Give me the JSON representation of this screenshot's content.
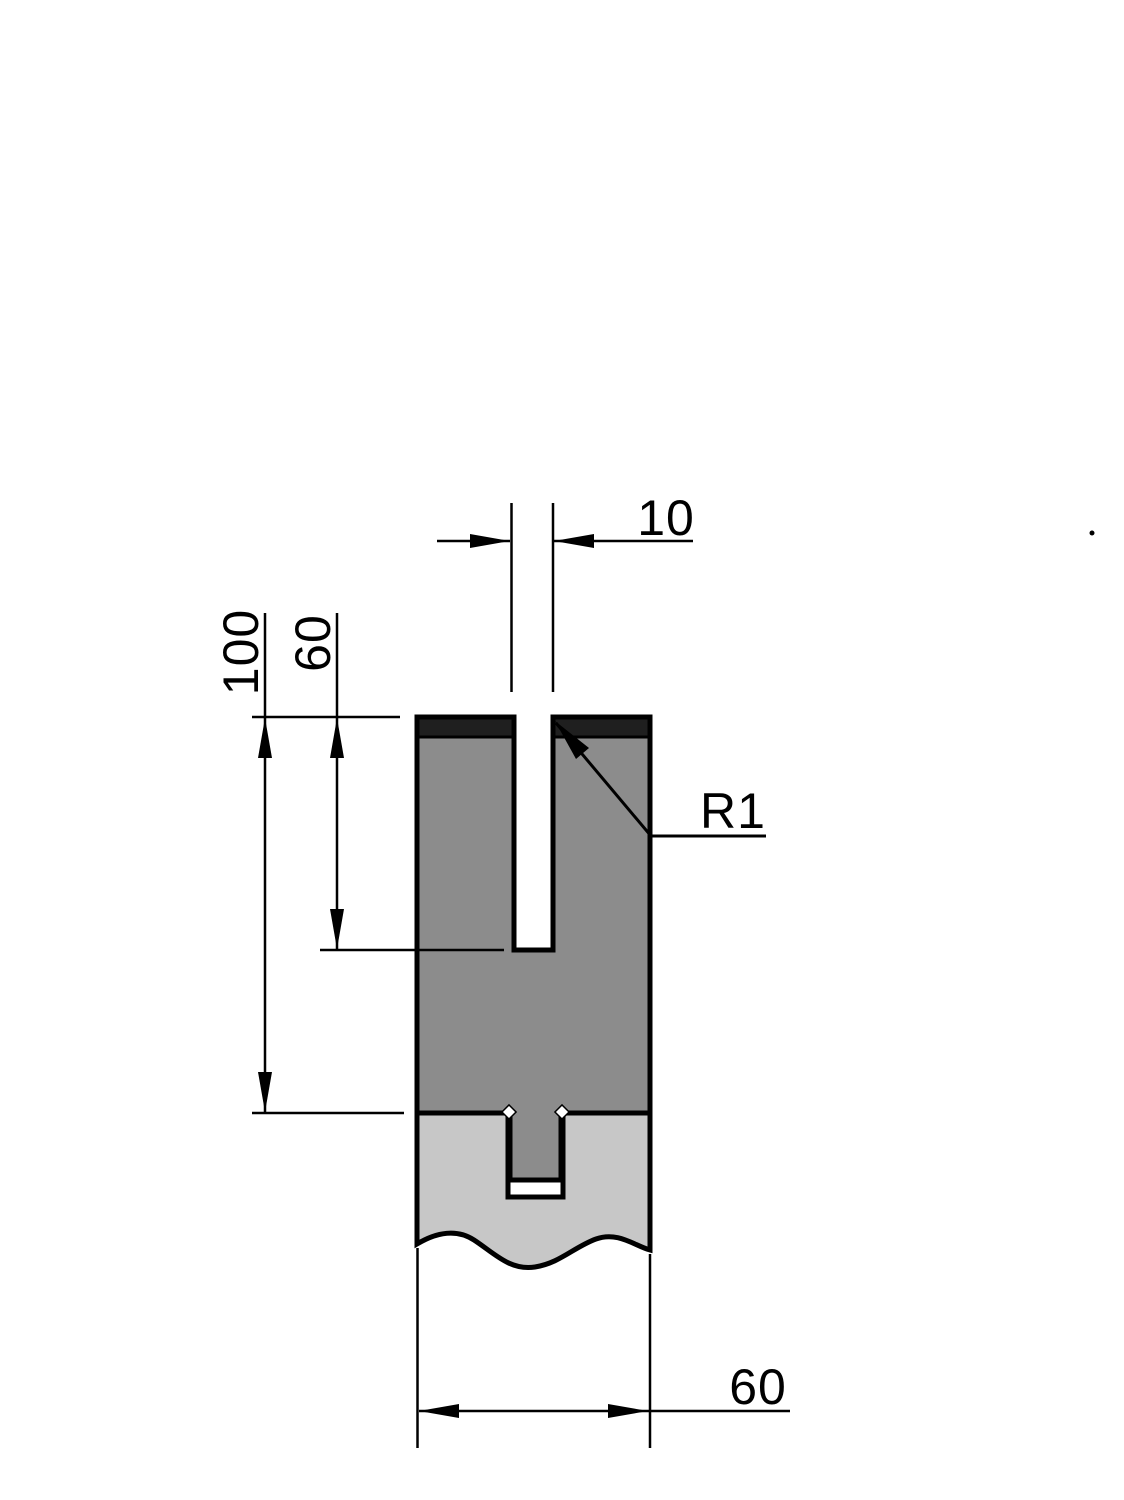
{
  "drawing": {
    "title": "press-brake-die-cross-section",
    "dimensions": {
      "slot_width": "10",
      "overall_height": "100",
      "slot_depth": "60",
      "corner_radius": "R1",
      "body_width": "60"
    },
    "colors": {
      "tool_body": "#8c8c8c",
      "hardened_zone": "#1f1f1f",
      "holder_body": "#c7c7c7",
      "line": "#000000",
      "background": "#ffffff"
    }
  }
}
